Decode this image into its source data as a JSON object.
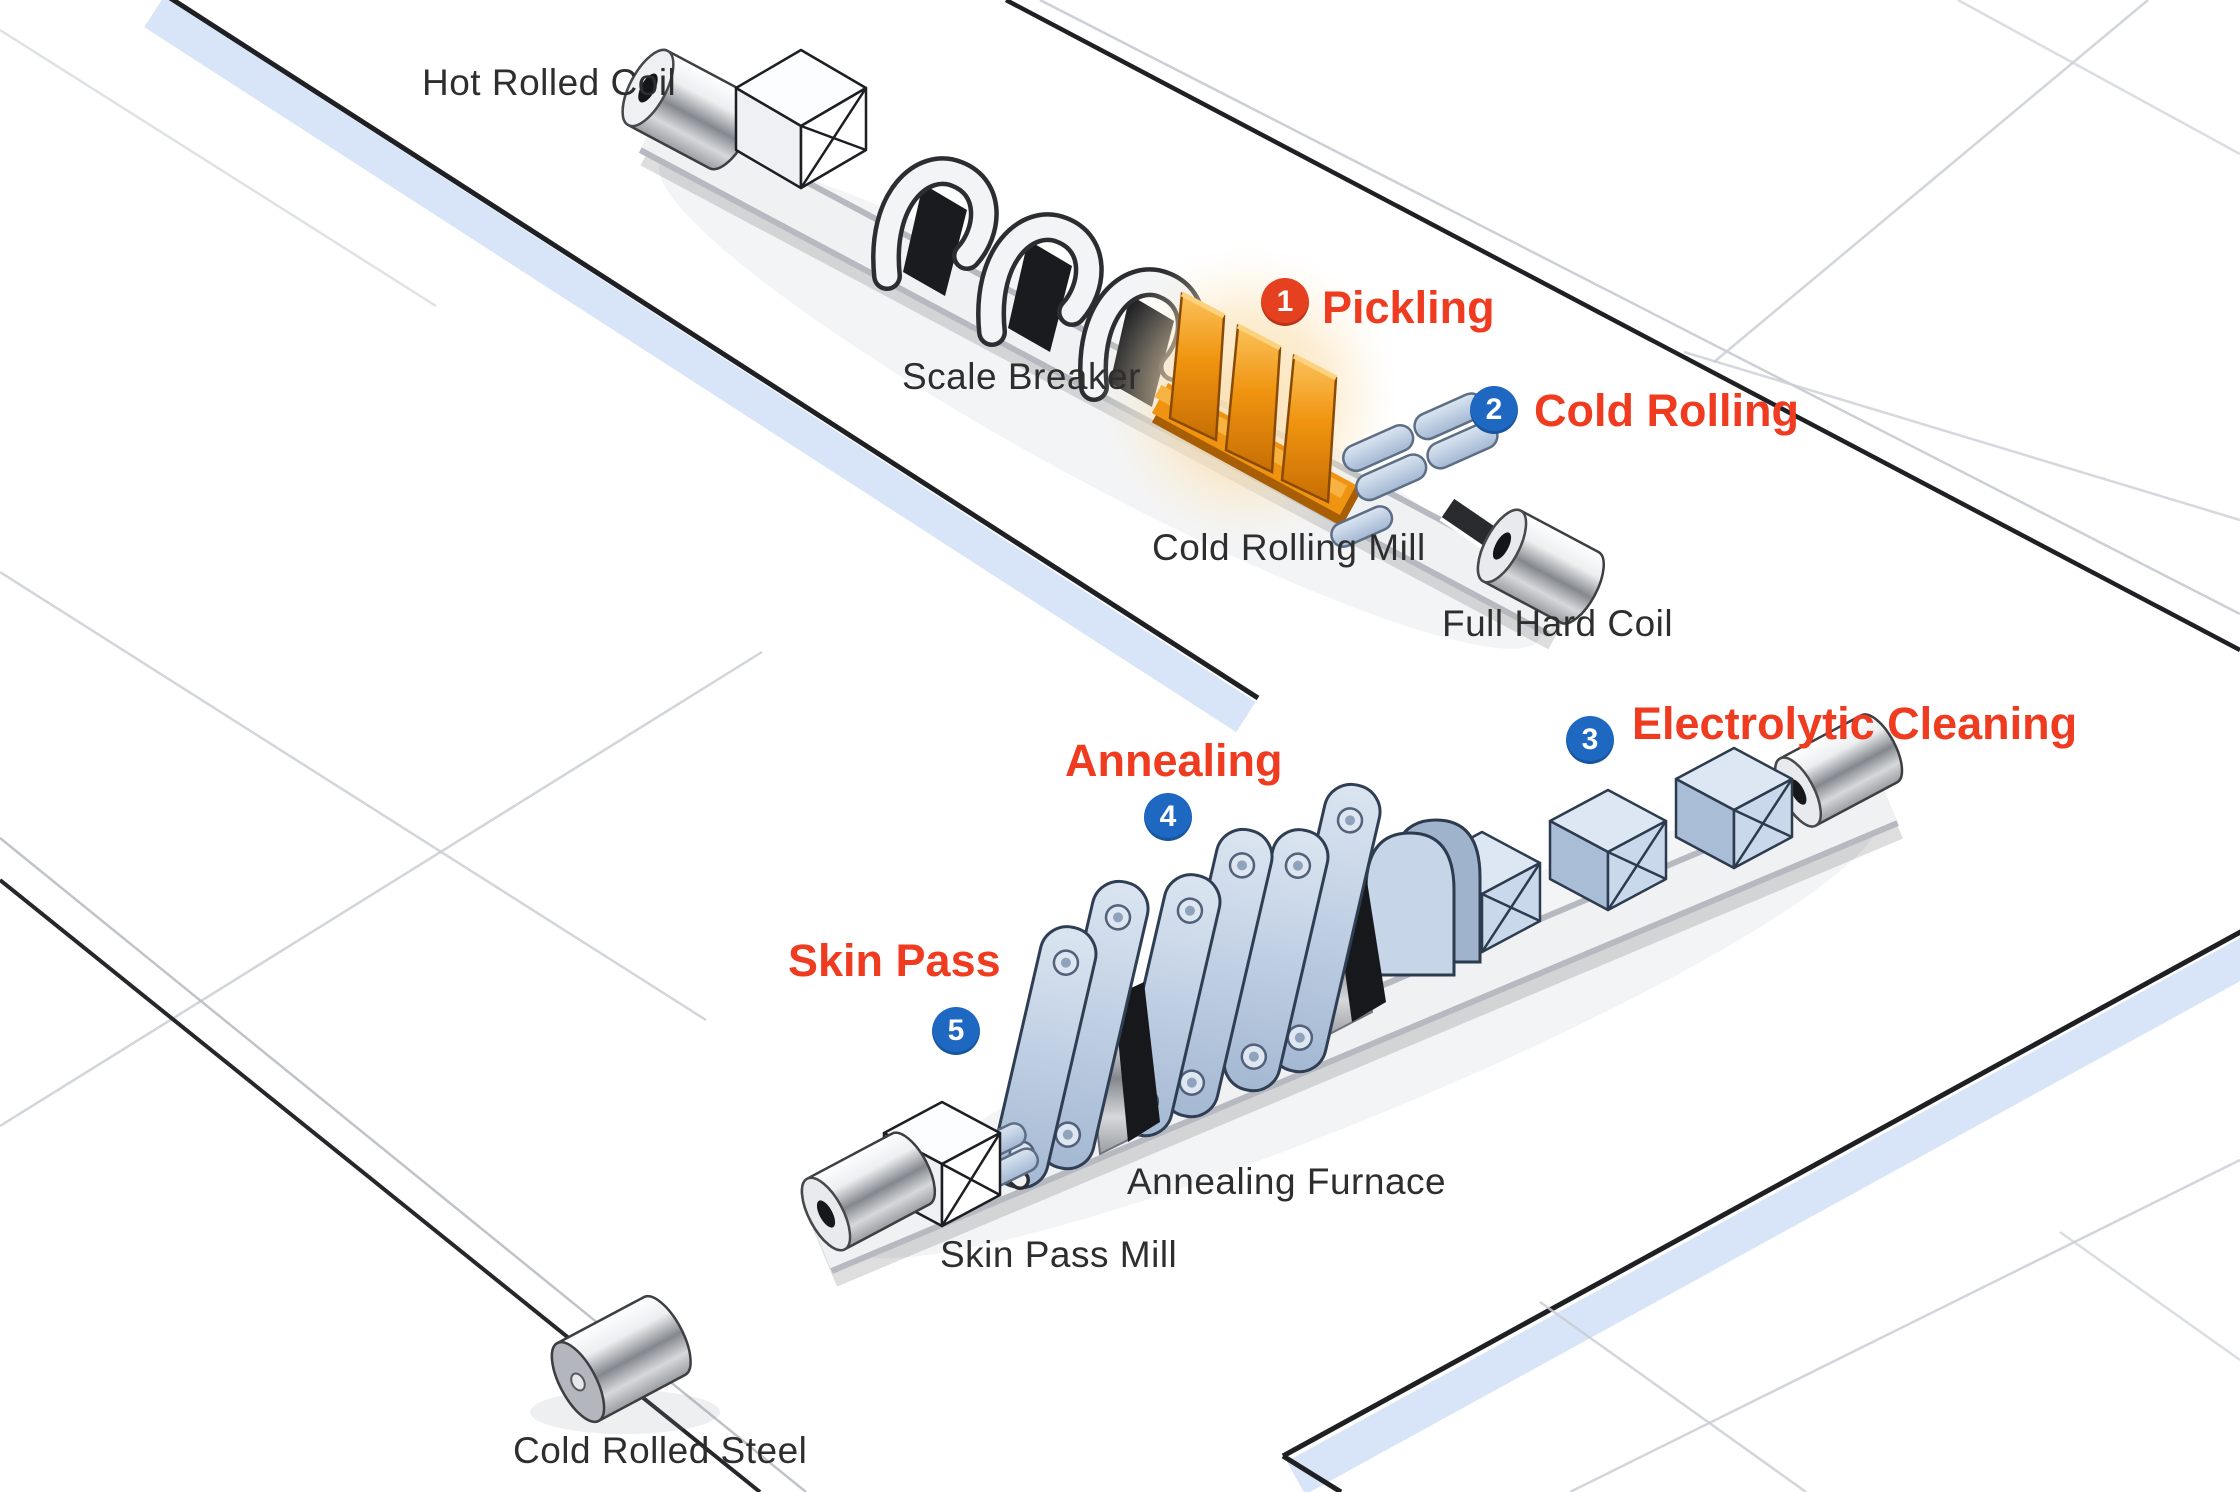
{
  "colors": {
    "step_red": "#ef3b1f",
    "badge_red": "#e5401f",
    "badge_blue": "#1e68c2",
    "label_dark": "#2e2e2e",
    "machine_orange": "#ef9311",
    "machine_blue": "#c6d5e8",
    "floor_stripe_blue": "#d8e5f8"
  },
  "steps": [
    {
      "number": "1",
      "label": "Pickling",
      "badge": "red"
    },
    {
      "number": "2",
      "label": "Cold Rolling",
      "badge": "blue"
    },
    {
      "number": "3",
      "label": "Electrolytic Cleaning",
      "badge": "blue"
    },
    {
      "number": "4",
      "label": "Annealing",
      "badge": "blue"
    },
    {
      "number": "5",
      "label": "Skin Pass",
      "badge": "blue"
    }
  ],
  "equipment": [
    {
      "label": "Hot Rolled Coil"
    },
    {
      "label": "Scale Breaker"
    },
    {
      "label": "Cold Rolling Mill"
    },
    {
      "label": "Full Hard Coil"
    },
    {
      "label": "Annealing Furnace"
    },
    {
      "label": "Skin Pass Mill"
    },
    {
      "label": "Cold Rolled Steel"
    }
  ]
}
